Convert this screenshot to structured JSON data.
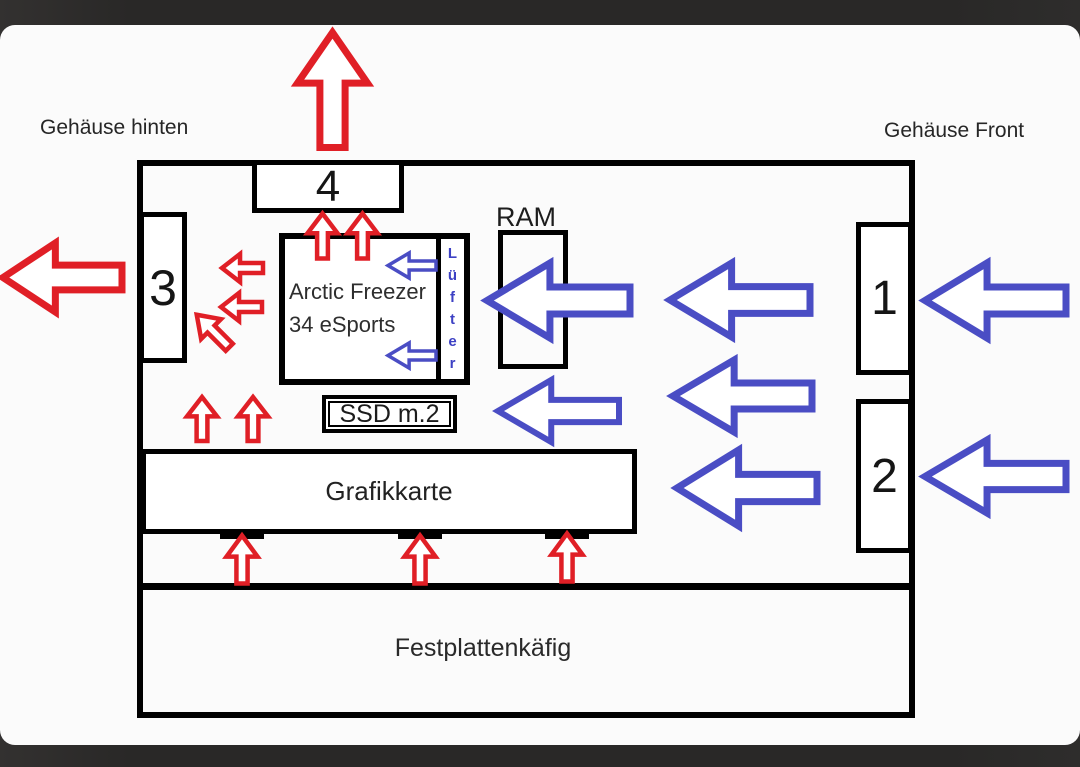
{
  "colors": {
    "exhaust_red": "#e01f26",
    "intake_blue": "#4a4dc4",
    "luefter_text": "#3d41c4",
    "line_black": "#000000"
  },
  "labels": {
    "rear_label": "Gehäuse hinten",
    "front_label": "Gehäuse Front"
  },
  "components": {
    "fan_top": "4",
    "fan_rear": "3",
    "fan_front_top": "1",
    "fan_front_bottom": "2",
    "ram": "RAM",
    "cooler_line1": "Arctic Freezer",
    "cooler_line2": "34 eSports",
    "cooler_fan": "Lüfter",
    "ssd": "SSD m.2",
    "gpu": "Grafikkarte",
    "hdd_cage": "Festplattenkäfig"
  },
  "arrows": [
    {
      "name": "top-exhaust",
      "color": "red",
      "dir": "up",
      "cx": 332,
      "cy": 90,
      "len": 115,
      "wid": 70,
      "stroke": 7
    },
    {
      "name": "rear-exhaust",
      "color": "red",
      "dir": "left",
      "cx": 62,
      "cy": 277,
      "len": 119,
      "wid": 69,
      "stroke": 7
    },
    {
      "name": "cooler-top-left",
      "color": "red",
      "dir": "up",
      "cx": 322,
      "cy": 236,
      "len": 45,
      "wid": 30,
      "stroke": 4.5
    },
    {
      "name": "cooler-top-right",
      "color": "red",
      "dir": "up",
      "cx": 362,
      "cy": 236,
      "len": 45,
      "wid": 30,
      "stroke": 4.5
    },
    {
      "name": "cooler-side-upper",
      "color": "red",
      "dir": "left",
      "cx": 242,
      "cy": 268,
      "len": 41,
      "wid": 28,
      "stroke": 4.5
    },
    {
      "name": "cooler-side-lower",
      "color": "red",
      "dir": "left",
      "cx": 241,
      "cy": 307,
      "len": 41,
      "wid": 28,
      "stroke": 4.5
    },
    {
      "name": "cooler-diagonal",
      "color": "red",
      "dir": "up-left",
      "cx": 213,
      "cy": 331,
      "len": 46,
      "wid": 28,
      "stroke": 4.5
    },
    {
      "name": "pcie-area-left",
      "color": "red",
      "dir": "up",
      "cx": 202,
      "cy": 419,
      "len": 44,
      "wid": 30,
      "stroke": 4.5
    },
    {
      "name": "pcie-area-right",
      "color": "red",
      "dir": "up",
      "cx": 253,
      "cy": 419,
      "len": 44,
      "wid": 30,
      "stroke": 4.5
    },
    {
      "name": "gpu-fan-left",
      "color": "red",
      "dir": "up",
      "cx": 242,
      "cy": 559,
      "len": 48,
      "wid": 31,
      "stroke": 4.5
    },
    {
      "name": "gpu-fan-middle",
      "color": "red",
      "dir": "up",
      "cx": 420,
      "cy": 559,
      "len": 48,
      "wid": 31,
      "stroke": 4.5
    },
    {
      "name": "gpu-fan-right",
      "color": "red",
      "dir": "up",
      "cx": 567,
      "cy": 557,
      "len": 48,
      "wid": 31,
      "stroke": 4.5
    },
    {
      "name": "front-intake-top",
      "color": "blue",
      "dir": "left",
      "cx": 995,
      "cy": 300,
      "len": 141,
      "wid": 75,
      "stroke": 7
    },
    {
      "name": "front-intake-bottom",
      "color": "blue",
      "dir": "left",
      "cx": 995,
      "cy": 476,
      "len": 141,
      "wid": 73,
      "stroke": 7
    },
    {
      "name": "mid-flow-top",
      "color": "blue",
      "dir": "left",
      "cx": 740,
      "cy": 300,
      "len": 140,
      "wid": 74,
      "stroke": 7
    },
    {
      "name": "mid-flow-middle",
      "color": "blue",
      "dir": "left",
      "cx": 742,
      "cy": 396,
      "len": 139,
      "wid": 72,
      "stroke": 7
    },
    {
      "name": "mid-flow-bottom",
      "color": "blue",
      "dir": "left",
      "cx": 747,
      "cy": 488,
      "len": 140,
      "wid": 76,
      "stroke": 7
    },
    {
      "name": "ram-flow",
      "color": "blue",
      "dir": "left",
      "cx": 558,
      "cy": 300,
      "len": 143,
      "wid": 75,
      "stroke": 7
    },
    {
      "name": "ssd-flow",
      "color": "blue",
      "dir": "left",
      "cx": 558,
      "cy": 411,
      "len": 121,
      "wid": 62,
      "stroke": 6
    },
    {
      "name": "cooler-fan-upper",
      "color": "blue",
      "dir": "left",
      "cx": 412,
      "cy": 265,
      "len": 48,
      "wid": 25,
      "stroke": 3.5
    },
    {
      "name": "cooler-fan-lower",
      "color": "blue",
      "dir": "left",
      "cx": 412,
      "cy": 355,
      "len": 48,
      "wid": 25,
      "stroke": 3.5
    }
  ]
}
